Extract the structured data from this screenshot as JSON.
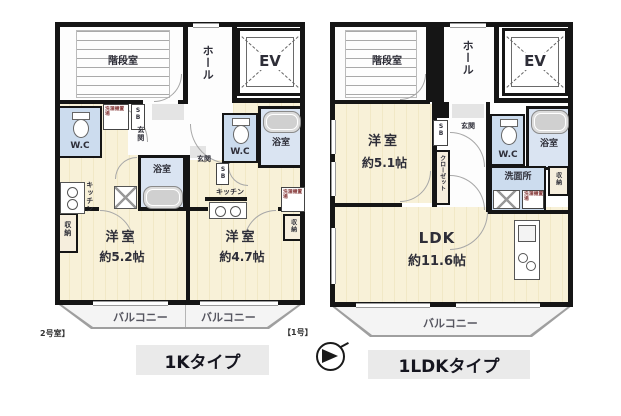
{
  "labels": {
    "stairwell": "階段室",
    "hall": "ホール",
    "elevator": "EV",
    "toilet": "W.C",
    "bath": "浴室",
    "entrance": "玄関",
    "kitchen": "キッチン",
    "storage": "収納",
    "shoe_box": "SB",
    "laundry": "洗濯機置場",
    "closet": "クローゼット",
    "washroom": "洗面所",
    "balcony": "バルコニー"
  },
  "left_plan": {
    "caption": "1Kタイプ",
    "unit_left_tag": "2号室】",
    "unit_right_tag": "【1号】",
    "room_left": {
      "name": "洋室",
      "size": "約5.2帖"
    },
    "room_right": {
      "name": "洋室",
      "size": "約4.7帖"
    }
  },
  "right_plan": {
    "caption": "1LDKタイプ",
    "bedroom": {
      "name": "洋室",
      "size": "約5.1帖"
    },
    "ldk": {
      "name": "LDK",
      "size": "約11.6帖"
    }
  },
  "colors": {
    "wall": "#151515",
    "room_cream": "#f8f1d8",
    "wet_blue": "#ccdcee",
    "bath_blue": "#dae4f2",
    "balcony_gray": "#f4f4f4",
    "caption_band": "#eaeaea"
  }
}
